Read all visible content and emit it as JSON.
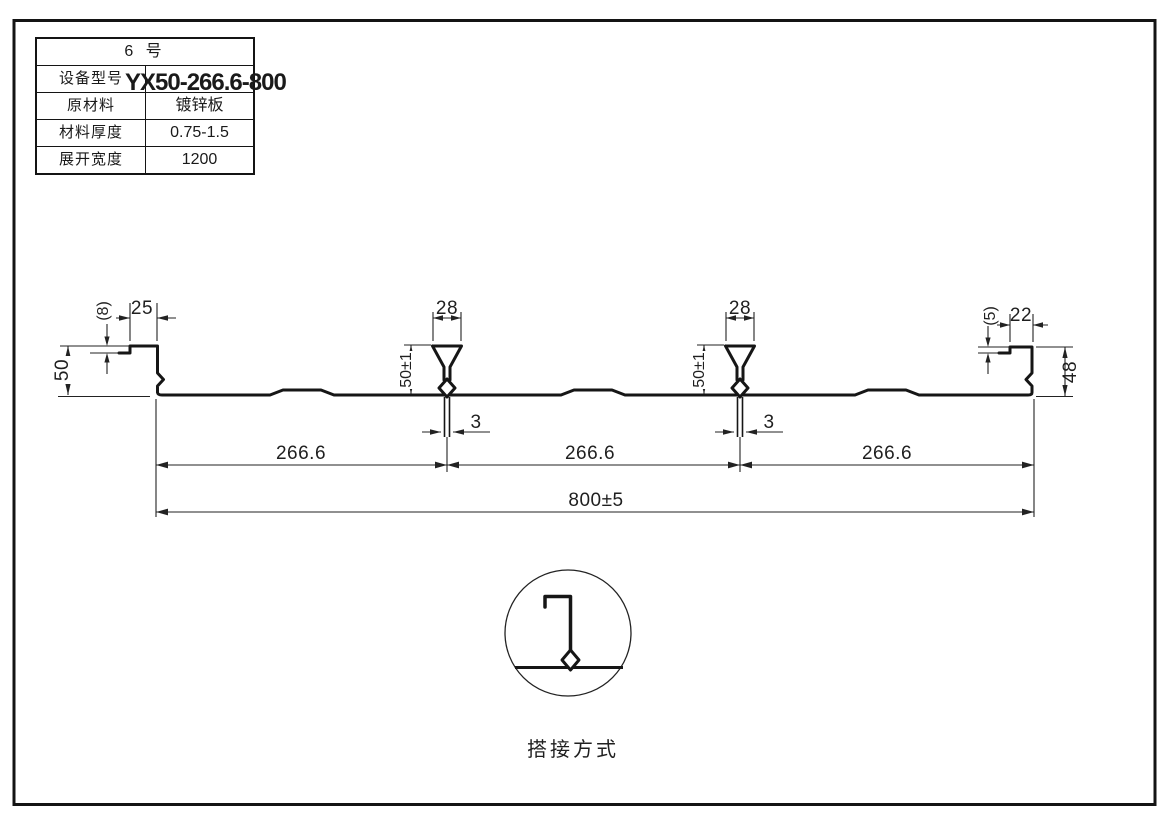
{
  "table": {
    "title": "6 号",
    "rows": [
      {
        "label": "设备型号",
        "value": "YX50-266.6-800"
      },
      {
        "label": "原材料",
        "value": "镀锌板"
      },
      {
        "label": "材料厚度",
        "value": "0.75-1.5"
      },
      {
        "label": "展开宽度",
        "value": "1200"
      }
    ]
  },
  "dims": {
    "left_step": "(8)",
    "left_lip": "25",
    "left_height": "50",
    "rib1_top": "28",
    "rib1_height": "50±1",
    "rib1_gap": "3",
    "rib2_top": "28",
    "rib2_height": "50±1",
    "rib2_gap": "3",
    "right_step": "(5)",
    "right_lip": "22",
    "right_height": "48",
    "span1": "266.6",
    "span2": "266.6",
    "span3": "266.6",
    "total": "800±5"
  },
  "detail": {
    "caption": "搭接方式"
  },
  "colors": {
    "line": "#1a1a1a",
    "background": "#ffffff"
  }
}
